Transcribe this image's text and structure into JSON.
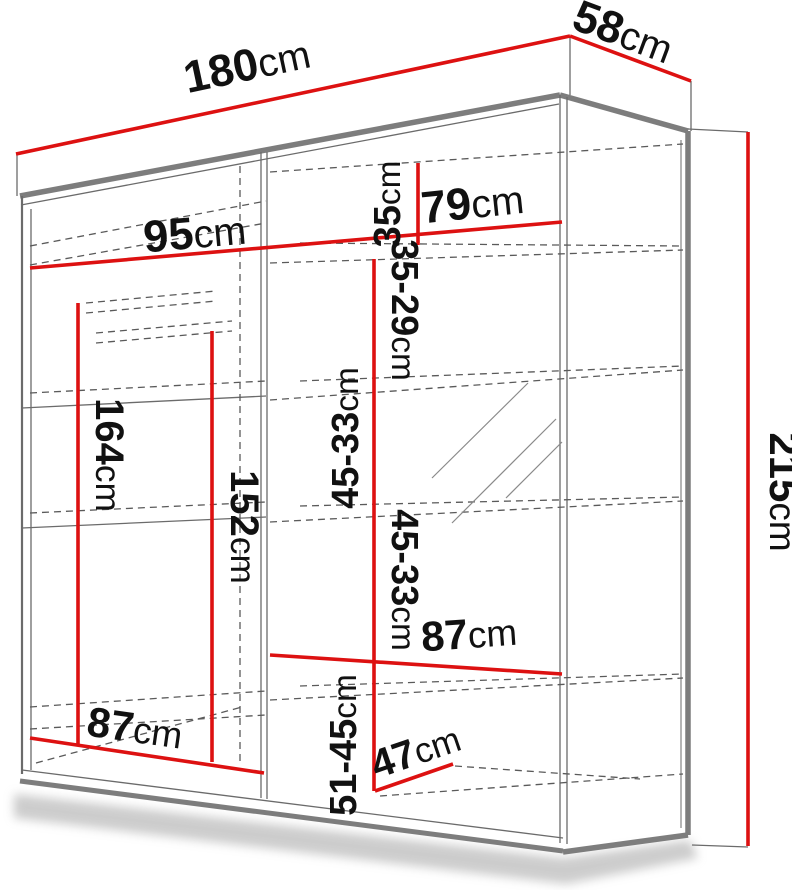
{
  "diagram": {
    "type": "wardrobe-dimension-diagram",
    "unit": "cm",
    "colors": {
      "dimension_line": "#dd1111",
      "edge_gray": "#7d7d7d",
      "dashed_gray": "#5a5a5a",
      "text": "#111111"
    },
    "dimensions": {
      "width": {
        "num": "180",
        "unit": "cm"
      },
      "depth": {
        "num": "58",
        "unit": "cm"
      },
      "height": {
        "num": "215",
        "unit": "cm"
      },
      "left_section_width": {
        "num": "95",
        "unit": "cm"
      },
      "right_section_width": {
        "num": "79",
        "unit": "cm"
      },
      "top_gap": {
        "num": "35",
        "unit": "cm"
      },
      "gap_35_29": {
        "num": "35-29",
        "unit": "cm"
      },
      "gap_45_33_upper": {
        "num": "45-33",
        "unit": "cm"
      },
      "gap_45_33_lower": {
        "num": "45-33",
        "unit": "cm"
      },
      "gap_51_45": {
        "num": "51-45",
        "unit": "cm"
      },
      "left_height": {
        "num": "164",
        "unit": "cm"
      },
      "center_height": {
        "num": "152",
        "unit": "cm"
      },
      "bottom_left_width": {
        "num": "87",
        "unit": "cm"
      },
      "bottom_right_width": {
        "num": "87",
        "unit": "cm"
      },
      "bottom_depth": {
        "num": "47",
        "unit": "cm"
      }
    }
  }
}
